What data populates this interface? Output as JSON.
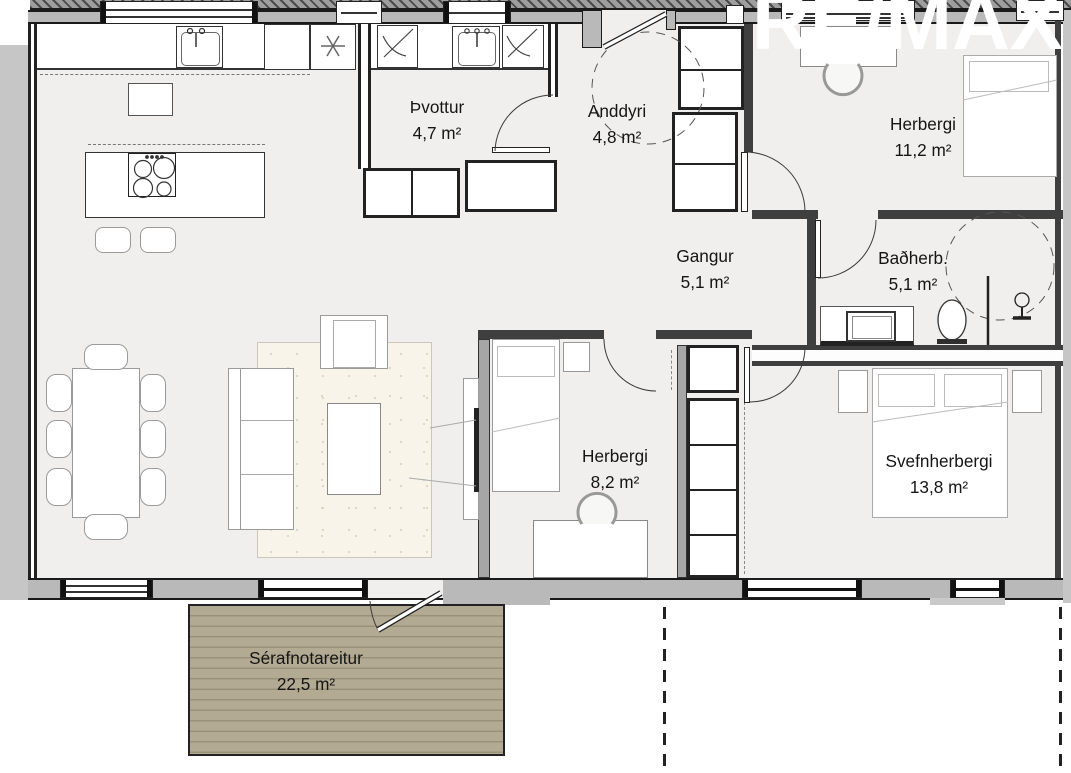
{
  "watermark": {
    "text": "RE/MAX"
  },
  "rooms": {
    "laundry": {
      "name": "Þvottur",
      "area": "4,7 m²"
    },
    "entry": {
      "name": "Anddyri",
      "area": "4,8 m²"
    },
    "bedroom1": {
      "name": "Herbergi",
      "area": "11,2 m²"
    },
    "hall": {
      "name": "Gangur",
      "area": "5,1 m²"
    },
    "bathroom": {
      "name": "Baðherb.",
      "area": "5,1 m²"
    },
    "bedroom2": {
      "name": "Herbergi",
      "area": "8,2 m²"
    },
    "master": {
      "name": "Svefnherbergi",
      "area": "13,8 m²"
    },
    "deck": {
      "name": "Sérafnotareitur",
      "area": "22,5 m²"
    }
  },
  "colors": {
    "floor": "#f0efed",
    "wall": "#3f3f3f",
    "exterior_band": "#c6c6c6",
    "deck": "#b3aa94",
    "rug": "#f8f4ea",
    "watermark": "#ffffff",
    "label_text": "#151515"
  }
}
